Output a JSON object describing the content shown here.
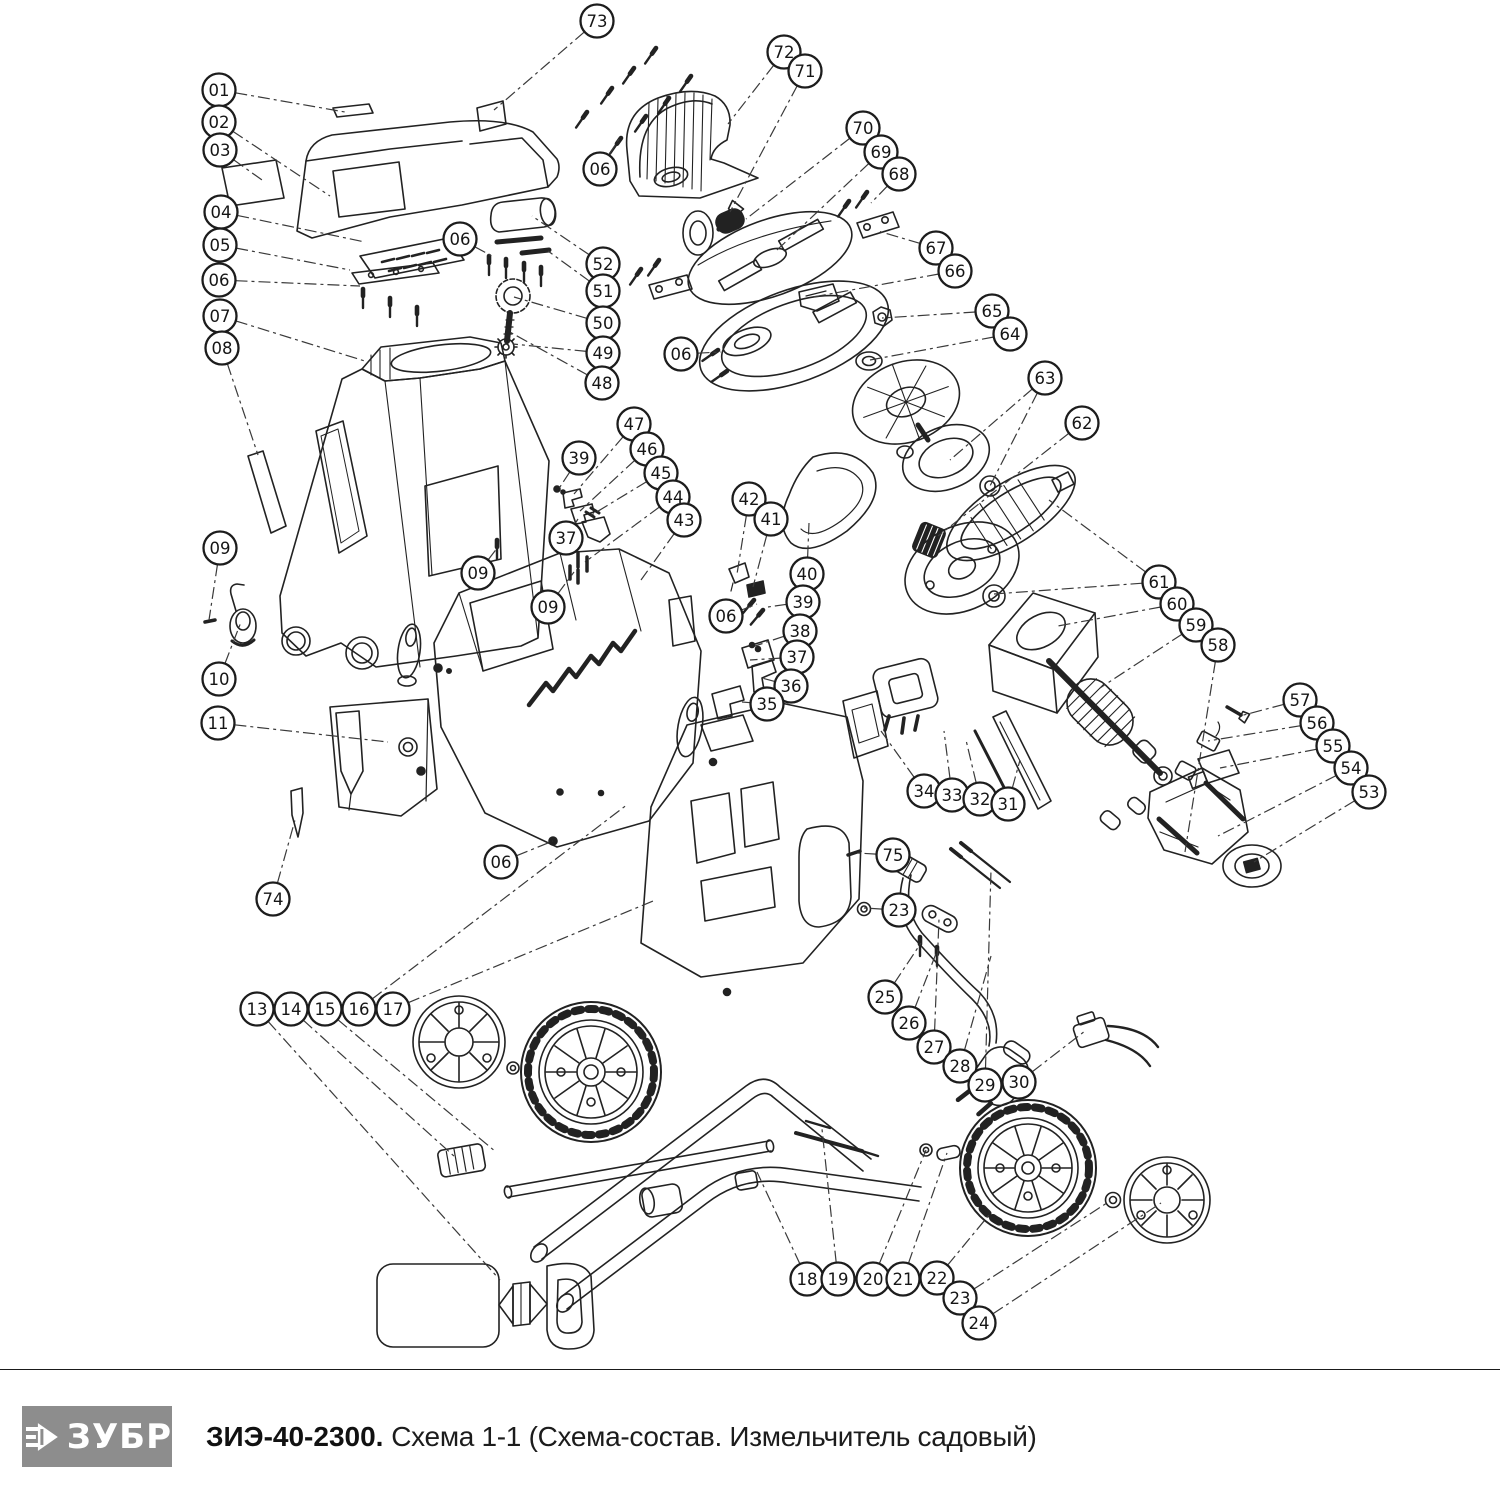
{
  "footer": {
    "brand": "ЗУБР",
    "model": "ЗИЭ-40-2300.",
    "subtitle": "Схема 1-1 (Схема-состав. Измельчитель садовый)"
  },
  "diagram": {
    "callouts": [
      {
        "label": "01",
        "x": 219,
        "y": 90,
        "targets": [
          [
            345,
            112
          ]
        ]
      },
      {
        "label": "02",
        "x": 219,
        "y": 122,
        "targets": [
          [
            330,
            196
          ]
        ]
      },
      {
        "label": "03",
        "x": 220,
        "y": 150,
        "targets": [
          [
            262,
            180
          ]
        ]
      },
      {
        "label": "04",
        "x": 221,
        "y": 212,
        "targets": [
          [
            365,
            242
          ]
        ]
      },
      {
        "label": "05",
        "x": 220,
        "y": 245,
        "targets": [
          [
            350,
            270
          ]
        ]
      },
      {
        "label": "06",
        "x": 219,
        "y": 280,
        "targets": [
          [
            360,
            286
          ]
        ]
      },
      {
        "label": "07",
        "x": 220,
        "y": 316,
        "targets": [
          [
            368,
            362
          ]
        ]
      },
      {
        "label": "08",
        "x": 222,
        "y": 348,
        "targets": [
          [
            258,
            455
          ]
        ]
      },
      {
        "label": "09",
        "x": 220,
        "y": 548,
        "targets": [
          [
            209,
            620
          ]
        ]
      },
      {
        "label": "10",
        "x": 219,
        "y": 679,
        "targets": [
          [
            241,
            622
          ]
        ]
      },
      {
        "label": "11",
        "x": 218,
        "y": 723,
        "targets": [
          [
            388,
            742
          ]
        ]
      },
      {
        "label": "74",
        "x": 273,
        "y": 899,
        "targets": [
          [
            295,
            820
          ]
        ]
      },
      {
        "label": "13",
        "x": 257,
        "y": 1009,
        "targets": [
          [
            500,
            1280
          ]
        ]
      },
      {
        "label": "14",
        "x": 291,
        "y": 1009,
        "targets": [
          [
            455,
            1157
          ]
        ]
      },
      {
        "label": "15",
        "x": 325,
        "y": 1009,
        "targets": [
          [
            496,
            1152
          ]
        ]
      },
      {
        "label": "16",
        "x": 359,
        "y": 1009,
        "targets": [
          [
            628,
            804
          ]
        ]
      },
      {
        "label": "17",
        "x": 393,
        "y": 1009,
        "targets": [
          [
            653,
            901
          ]
        ]
      },
      {
        "label": "06",
        "x": 460,
        "y": 239,
        "targets": [
          [
            492,
            256
          ]
        ]
      },
      {
        "label": "52",
        "x": 603,
        "y": 264,
        "targets": [
          [
            532,
            216
          ]
        ]
      },
      {
        "label": "51",
        "x": 603,
        "y": 291,
        "targets": [
          [
            548,
            251
          ]
        ]
      },
      {
        "label": "50",
        "x": 603,
        "y": 323,
        "targets": [
          [
            514,
            297
          ]
        ]
      },
      {
        "label": "49",
        "x": 603,
        "y": 353,
        "targets": [
          [
            513,
            344
          ]
        ]
      },
      {
        "label": "48",
        "x": 602,
        "y": 383,
        "targets": [
          [
            508,
            331
          ]
        ]
      },
      {
        "label": "73",
        "x": 597,
        "y": 21,
        "targets": [
          [
            494,
            110
          ]
        ]
      },
      {
        "label": "06",
        "x": 600,
        "y": 169,
        "targets": [
          [
            619,
            139
          ]
        ]
      },
      {
        "label": "72",
        "x": 784,
        "y": 52,
        "targets": [
          [
            728,
            124
          ]
        ]
      },
      {
        "label": "71",
        "x": 805,
        "y": 71,
        "targets": [
          [
            730,
            212
          ]
        ]
      },
      {
        "label": "70",
        "x": 863,
        "y": 128,
        "targets": [
          [
            746,
            219
          ]
        ]
      },
      {
        "label": "69",
        "x": 881,
        "y": 152,
        "targets": [
          [
            777,
            250
          ]
        ]
      },
      {
        "label": "68",
        "x": 899,
        "y": 174,
        "targets": [
          [
            871,
            203
          ]
        ]
      },
      {
        "label": "67",
        "x": 936,
        "y": 248,
        "targets": [
          [
            878,
            231
          ]
        ]
      },
      {
        "label": "66",
        "x": 955,
        "y": 271,
        "targets": [
          [
            813,
            297
          ]
        ]
      },
      {
        "label": "65",
        "x": 992,
        "y": 311,
        "targets": [
          [
            882,
            318
          ]
        ]
      },
      {
        "label": "64",
        "x": 1010,
        "y": 334,
        "targets": [
          [
            870,
            360
          ]
        ]
      },
      {
        "label": "63",
        "x": 1045,
        "y": 378,
        "targets": [
          [
            950,
            460
          ],
          [
            990,
            486
          ]
        ]
      },
      {
        "label": "62",
        "x": 1082,
        "y": 423,
        "targets": [
          [
            938,
            536
          ]
        ]
      },
      {
        "label": "06",
        "x": 681,
        "y": 354,
        "targets": [
          [
            721,
            352
          ]
        ]
      },
      {
        "label": "06",
        "x": 726,
        "y": 616,
        "targets": [
          [
            757,
            604
          ]
        ]
      },
      {
        "label": "61",
        "x": 1159,
        "y": 582,
        "targets": [
          [
            1049,
            500
          ],
          [
            994,
            594
          ]
        ]
      },
      {
        "label": "60",
        "x": 1177,
        "y": 604,
        "targets": [
          [
            1058,
            626
          ]
        ]
      },
      {
        "label": "59",
        "x": 1196,
        "y": 625,
        "targets": [
          [
            1100,
            688
          ]
        ]
      },
      {
        "label": "58",
        "x": 1218,
        "y": 645,
        "targets": [
          [
            1185,
            852
          ]
        ]
      },
      {
        "label": "57",
        "x": 1300,
        "y": 700,
        "targets": [
          [
            1240,
            716
          ]
        ]
      },
      {
        "label": "56",
        "x": 1317,
        "y": 723,
        "targets": [
          [
            1208,
            741
          ]
        ]
      },
      {
        "label": "55",
        "x": 1333,
        "y": 746,
        "targets": [
          [
            1220,
            768
          ]
        ]
      },
      {
        "label": "54",
        "x": 1351,
        "y": 768,
        "targets": [
          [
            1218,
            836
          ]
        ]
      },
      {
        "label": "53",
        "x": 1369,
        "y": 792,
        "targets": [
          [
            1254,
            862
          ]
        ]
      },
      {
        "label": "47",
        "x": 634,
        "y": 424,
        "targets": [
          [
            574,
            494
          ]
        ]
      },
      {
        "label": "46",
        "x": 647,
        "y": 449,
        "targets": [
          [
            580,
            511
          ]
        ]
      },
      {
        "label": "45",
        "x": 661,
        "y": 473,
        "targets": [
          [
            590,
            516
          ]
        ]
      },
      {
        "label": "44",
        "x": 673,
        "y": 497,
        "targets": [
          [
            585,
            562
          ]
        ]
      },
      {
        "label": "43",
        "x": 684,
        "y": 520,
        "targets": [
          [
            641,
            580
          ]
        ]
      },
      {
        "label": "39",
        "x": 579,
        "y": 458,
        "targets": [
          [
            558,
            490
          ]
        ]
      },
      {
        "label": "37",
        "x": 566,
        "y": 538,
        "targets": [
          [
            578,
            519
          ]
        ]
      },
      {
        "label": "09",
        "x": 478,
        "y": 573,
        "targets": [
          [
            498,
            547
          ]
        ]
      },
      {
        "label": "09",
        "x": 548,
        "y": 607,
        "targets": [
          [
            574,
            572
          ]
        ]
      },
      {
        "label": "42",
        "x": 749,
        "y": 499,
        "targets": [
          [
            737,
            574
          ]
        ]
      },
      {
        "label": "41",
        "x": 771,
        "y": 519,
        "targets": [
          [
            753,
            587
          ]
        ]
      },
      {
        "label": "40",
        "x": 807,
        "y": 574,
        "targets": [
          [
            809,
            523
          ]
        ]
      },
      {
        "label": "39",
        "x": 803,
        "y": 602,
        "targets": [
          [
            768,
            607
          ]
        ]
      },
      {
        "label": "38",
        "x": 800,
        "y": 631,
        "targets": [
          [
            755,
            646
          ]
        ]
      },
      {
        "label": "37",
        "x": 797,
        "y": 657,
        "targets": [
          [
            750,
            660
          ]
        ]
      },
      {
        "label": "36",
        "x": 791,
        "y": 686,
        "targets": [
          [
            762,
            678
          ]
        ]
      },
      {
        "label": "35",
        "x": 767,
        "y": 704,
        "targets": [
          [
            742,
            702
          ]
        ]
      },
      {
        "label": "34",
        "x": 924,
        "y": 791,
        "targets": [
          [
            881,
            731
          ]
        ]
      },
      {
        "label": "33",
        "x": 952,
        "y": 795,
        "targets": [
          [
            944,
            731
          ]
        ]
      },
      {
        "label": "32",
        "x": 980,
        "y": 799,
        "targets": [
          [
            966,
            740
          ]
        ]
      },
      {
        "label": "31",
        "x": 1008,
        "y": 804,
        "targets": [
          [
            1020,
            760
          ]
        ]
      },
      {
        "label": "75",
        "x": 893,
        "y": 855,
        "targets": [
          [
            857,
            853
          ]
        ]
      },
      {
        "label": "23",
        "x": 899,
        "y": 910,
        "targets": [
          [
            864,
            908
          ]
        ]
      },
      {
        "label": "25",
        "x": 885,
        "y": 997,
        "targets": [
          [
            921,
            943
          ]
        ]
      },
      {
        "label": "26",
        "x": 909,
        "y": 1023,
        "targets": [
          [
            937,
            951
          ]
        ]
      },
      {
        "label": "27",
        "x": 934,
        "y": 1047,
        "targets": [
          [
            939,
            919
          ]
        ]
      },
      {
        "label": "28",
        "x": 960,
        "y": 1066,
        "targets": [
          [
            991,
            956
          ]
        ]
      },
      {
        "label": "29",
        "x": 985,
        "y": 1085,
        "targets": [
          [
            991,
            870
          ]
        ]
      },
      {
        "label": "30",
        "x": 1019,
        "y": 1082,
        "targets": [
          [
            1085,
            1031
          ]
        ]
      },
      {
        "label": "18",
        "x": 807,
        "y": 1279,
        "targets": [
          [
            757,
            1172
          ]
        ]
      },
      {
        "label": "19",
        "x": 838,
        "y": 1279,
        "targets": [
          [
            822,
            1129
          ]
        ]
      },
      {
        "label": "20",
        "x": 873,
        "y": 1279,
        "targets": [
          [
            926,
            1150
          ]
        ]
      },
      {
        "label": "21",
        "x": 903,
        "y": 1279,
        "targets": [
          [
            947,
            1153
          ]
        ]
      },
      {
        "label": "22",
        "x": 937,
        "y": 1278,
        "targets": [
          [
            989,
            1215
          ]
        ]
      },
      {
        "label": "23",
        "x": 960,
        "y": 1298,
        "targets": [
          [
            1110,
            1201
          ]
        ]
      },
      {
        "label": "24",
        "x": 979,
        "y": 1323,
        "targets": [
          [
            1161,
            1203
          ]
        ]
      },
      {
        "label": "06",
        "x": 501,
        "y": 862,
        "targets": [
          [
            553,
            841
          ]
        ]
      }
    ]
  }
}
